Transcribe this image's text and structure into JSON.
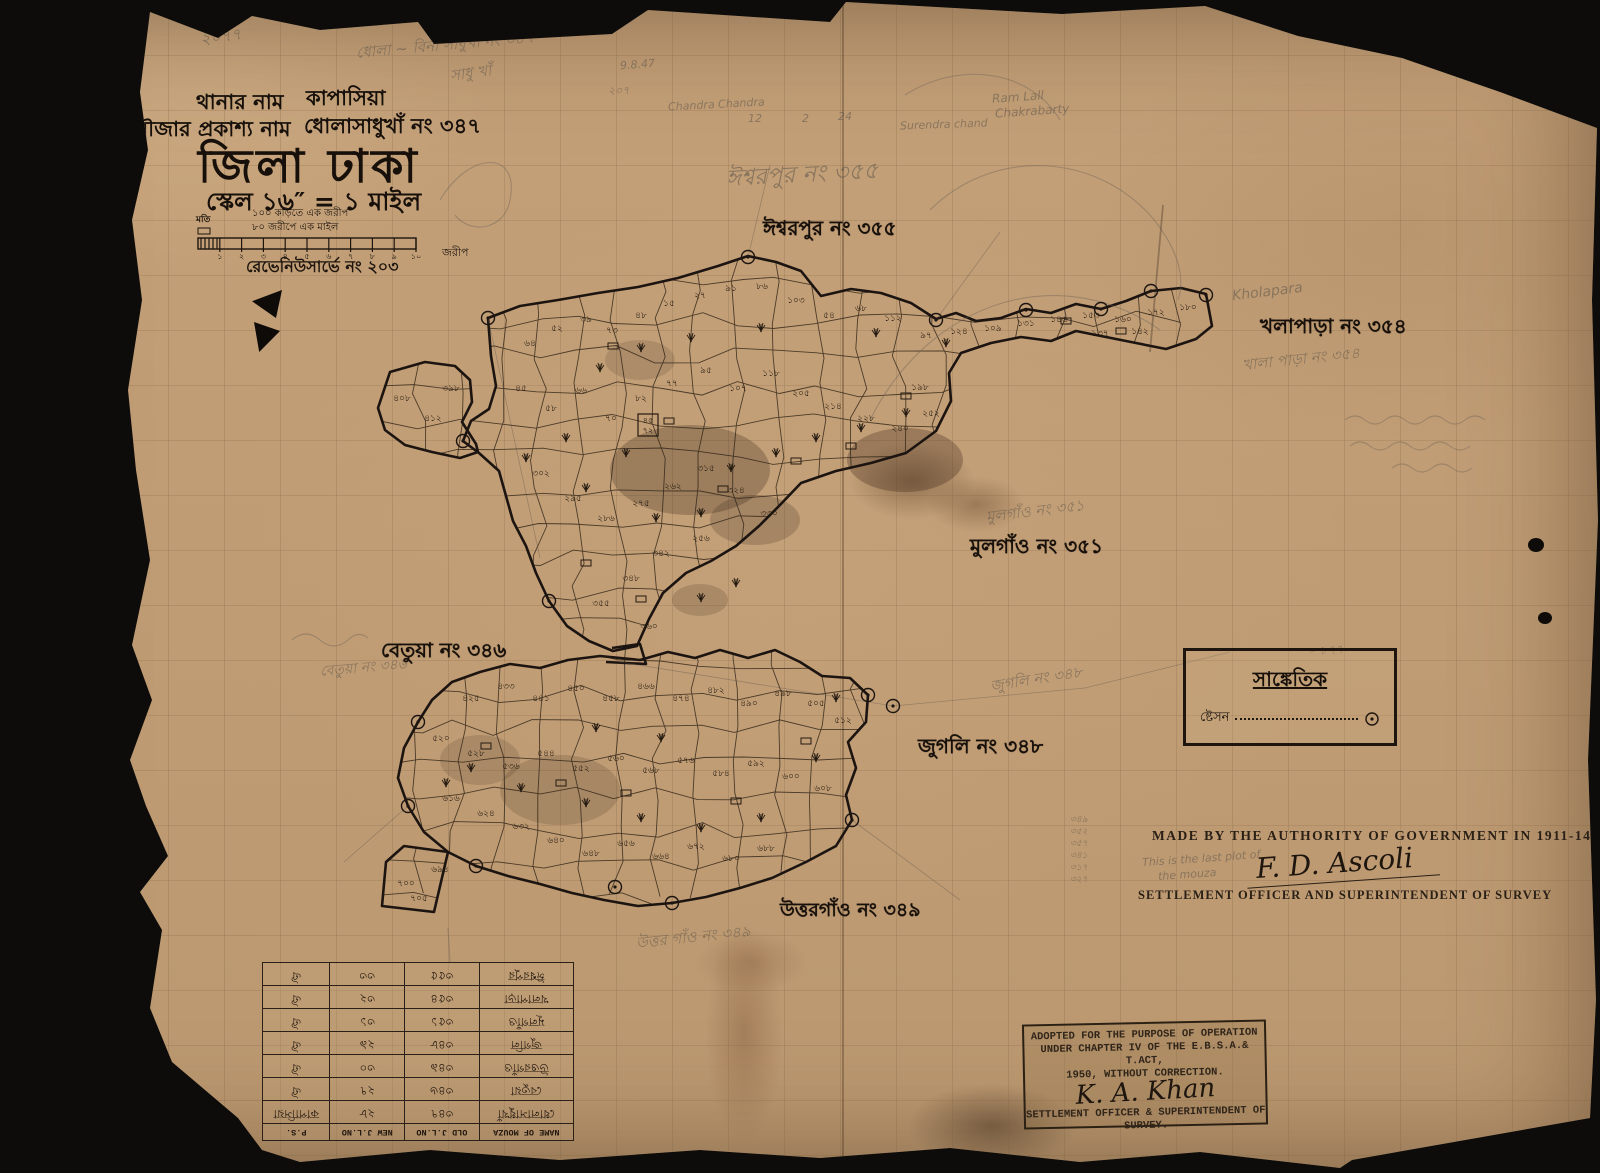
{
  "colors": {
    "ink": "#1d150e",
    "pencil": "#5d564b",
    "paper": "#c4a078",
    "boundary": "#1c1410"
  },
  "header": {
    "thana_label": "থানার নাম",
    "thana_value": "কাপাসিয়া",
    "mouza_label": "মৌজার প্রকাশ্য নাম",
    "mouza_value": "ধোলাসাধুখাঁ নং ৩৪৭",
    "district_title": "জিলা ঢাকা",
    "scale_line": "স্কেল ১৬″ = ১ মাইল",
    "scale_note1": "১০০ কড়িতে এক জরীপ",
    "scale_note2": "৮০ জরীপে এক মাইল",
    "scale_left_label": "মতি",
    "scale_ticks": [
      "১",
      "২",
      "৩",
      "৪",
      "৫",
      "৬",
      "৭",
      "৮",
      "৯",
      "১০"
    ],
    "scale_unit_right": "জরীপ",
    "survey_no": "রেভেনিউসার্ভে নং ২০৩"
  },
  "legend": {
    "title": "সাঙ্কেতিক",
    "station_label": "ষ্টেসন",
    "station_symbol": "station-circled-dot"
  },
  "authority": {
    "line1": "MADE BY THE AUTHORITY OF GOVERNMENT IN 1911-14",
    "signature": "F. D. Ascoli",
    "line2": "SETTLEMENT OFFICER AND SUPERINTENDENT OF SURVEY"
  },
  "stamp": {
    "line1": "ADOPTED FOR THE PURPOSE OF OPERATION",
    "line2": "UNDER CHAPTER IV OF THE E.B.S.A.& T.ACT,",
    "line3": "1950, WITHOUT CORRECTION.",
    "signature": "K. A. Khan",
    "line4": "SETTLEMENT OFFICER & SUPERINTENDENT OF",
    "line5": "SURVEY."
  },
  "table": {
    "headers": [
      "NAME OF MOUZA",
      "OLD J.L.NO",
      "NEW J.L.NO",
      "P.S."
    ],
    "rows": [
      [
        "ধোলাসাধুখাঁ",
        "৩৪৭",
        "২৮",
        "কাপাসিয়া"
      ],
      [
        "বেতুয়া",
        "৩৪৬",
        "২৭",
        "ঐ"
      ],
      [
        "উত্তরগাঁও",
        "৩৪৯",
        "৩০",
        "ঐ"
      ],
      [
        "জুগলি",
        "৩৪৮",
        "২৯",
        "ঐ"
      ],
      [
        "মূলগাঁও",
        "৩৫১",
        "৩১",
        "ঐ"
      ],
      [
        "খলাপাড়া",
        "৩৫৪",
        "৩২",
        "ঐ"
      ],
      [
        "ঈশ্বরপুর",
        "৩৫৫",
        "৩৩",
        "ঐ"
      ]
    ]
  },
  "map": {
    "region_labels": [
      {
        "t": "ঈশ্বরপুর নং ৩৫৫",
        "x": 763,
        "y": 214,
        "s": 20
      },
      {
        "t": "খলাপাড়া নং ৩৫৪",
        "x": 1260,
        "y": 312,
        "s": 20
      },
      {
        "t": "মুলগাঁও নং ৩৫১",
        "x": 970,
        "y": 532,
        "s": 20
      },
      {
        "t": "বেতুয়া নং ৩৪৬",
        "x": 381,
        "y": 636,
        "s": 20
      },
      {
        "t": "জুগলি নং ৩৪৮",
        "x": 918,
        "y": 732,
        "s": 20
      },
      {
        "t": "উত্তরগাঁও নং ৩৪৯",
        "x": 780,
        "y": 896,
        "s": 19
      }
    ],
    "pencil_notes": [
      {
        "t": "২০৭৭",
        "x": 200,
        "y": 24,
        "s": 16,
        "r": -8
      },
      {
        "t": "ধোলা ~ বিনা সাধুখাঁ নং ৩৪৭",
        "x": 356,
        "y": 34,
        "s": 15,
        "r": -5
      },
      {
        "t": "সাধু খাঁ",
        "x": 450,
        "y": 62,
        "s": 15,
        "r": -8
      },
      {
        "t": "9.8.47",
        "x": 620,
        "y": 58,
        "s": 11,
        "r": -4
      },
      {
        "t": "২০৭",
        "x": 608,
        "y": 82,
        "s": 11,
        "r": 0
      },
      {
        "t": "Chandra Chandra",
        "x": 668,
        "y": 98,
        "s": 11,
        "r": -3
      },
      {
        "t": "12",
        "x": 748,
        "y": 112,
        "s": 11,
        "r": 0
      },
      {
        "t": "2",
        "x": 802,
        "y": 112,
        "s": 11,
        "r": 0
      },
      {
        "t": "24",
        "x": 838,
        "y": 110,
        "s": 11,
        "r": 0
      },
      {
        "t": "Surendra chand",
        "x": 900,
        "y": 118,
        "s": 11,
        "r": -2
      },
      {
        "t": "Ram Lall",
        "x": 992,
        "y": 90,
        "s": 12,
        "r": -4
      },
      {
        "t": "Chakrabarty",
        "x": 995,
        "y": 104,
        "s": 12,
        "r": -4
      },
      {
        "t": "Kholapara",
        "x": 1232,
        "y": 284,
        "s": 14,
        "r": -7
      },
      {
        "t": "খালা পাড়া নং ৩৫৪",
        "x": 1242,
        "y": 348,
        "s": 15,
        "r": -6
      },
      {
        "t": "ঈশ্বরপুর নং ৩৫৫",
        "x": 726,
        "y": 156,
        "s": 23,
        "r": -3
      },
      {
        "t": "মুলগাঁও নং ৩৫১",
        "x": 986,
        "y": 500,
        "s": 15,
        "r": -7
      },
      {
        "t": "জুগলি নং ৩৪৮",
        "x": 990,
        "y": 668,
        "s": 15,
        "r": -9
      },
      {
        "t": "বেতুয়া নং ৩৪৬",
        "x": 320,
        "y": 656,
        "s": 14,
        "r": -5
      },
      {
        "t": "উত্তর গাঁও নং ৩৪৯",
        "x": 636,
        "y": 926,
        "s": 15,
        "r": -6
      },
      {
        "t": "This is the last plot of",
        "x": 1142,
        "y": 852,
        "s": 11,
        "r": -4
      },
      {
        "t": "the mouza",
        "x": 1158,
        "y": 868,
        "s": 11,
        "r": -4
      },
      {
        "t": "৮৭৭",
        "x": 1320,
        "y": 642,
        "s": 12,
        "r": -3
      },
      {
        "t": "৩৪৯",
        "x": 1070,
        "y": 812,
        "s": 9,
        "r": 0
      },
      {
        "t": "৩৫২",
        "x": 1070,
        "y": 824,
        "s": 9,
        "r": 0
      },
      {
        "t": "৩৫৭",
        "x": 1070,
        "y": 836,
        "s": 9,
        "r": 0
      },
      {
        "t": "৩৪১",
        "x": 1070,
        "y": 848,
        "s": 9,
        "r": 0
      },
      {
        "t": "৩১৭",
        "x": 1070,
        "y": 860,
        "s": 9,
        "r": 0
      },
      {
        "t": "৩২৭",
        "x": 1070,
        "y": 872,
        "s": 9,
        "r": 0
      }
    ],
    "boxed_label": {
      "top": "৪৫",
      "bottom": "৭২",
      "x": 648,
      "y": 424
    },
    "plot_labels": [
      {
        "t": "৬৪",
        "x": 530,
        "y": 346
      },
      {
        "t": "৫২",
        "x": 557,
        "y": 331
      },
      {
        "t": "৩৯",
        "x": 586,
        "y": 322
      },
      {
        "t": "৭৩",
        "x": 612,
        "y": 333
      },
      {
        "t": "৪৮",
        "x": 641,
        "y": 318
      },
      {
        "t": "১৫",
        "x": 669,
        "y": 306
      },
      {
        "t": "২৭",
        "x": 700,
        "y": 298
      },
      {
        "t": "৯১",
        "x": 731,
        "y": 291
      },
      {
        "t": "৮৬",
        "x": 762,
        "y": 289
      },
      {
        "t": "১০৩",
        "x": 796,
        "y": 303
      },
      {
        "t": "৫৪",
        "x": 829,
        "y": 318
      },
      {
        "t": "৬৮",
        "x": 861,
        "y": 311
      },
      {
        "t": "১১২",
        "x": 893,
        "y": 321
      },
      {
        "t": "৯৭",
        "x": 926,
        "y": 338
      },
      {
        "t": "১২৪",
        "x": 959,
        "y": 334
      },
      {
        "t": "১০৯",
        "x": 993,
        "y": 331
      },
      {
        "t": "১৩১",
        "x": 1026,
        "y": 326
      },
      {
        "t": "১৪৬",
        "x": 1059,
        "y": 322
      },
      {
        "t": "১৫৩",
        "x": 1091,
        "y": 318
      },
      {
        "t": "১৬০",
        "x": 1123,
        "y": 322
      },
      {
        "t": "১৭২",
        "x": 1156,
        "y": 315
      },
      {
        "t": "১৮০",
        "x": 1188,
        "y": 310
      },
      {
        "t": "১৩৭",
        "x": 1100,
        "y": 336
      },
      {
        "t": "১৪২",
        "x": 1140,
        "y": 334
      },
      {
        "t": "৪৫",
        "x": 521,
        "y": 391
      },
      {
        "t": "৫৮",
        "x": 551,
        "y": 411
      },
      {
        "t": "৬৬",
        "x": 581,
        "y": 393
      },
      {
        "t": "৭০",
        "x": 611,
        "y": 421
      },
      {
        "t": "৮২",
        "x": 641,
        "y": 401
      },
      {
        "t": "৭৭",
        "x": 672,
        "y": 386
      },
      {
        "t": "৯৫",
        "x": 706,
        "y": 373
      },
      {
        "t": "১০৭",
        "x": 738,
        "y": 391
      },
      {
        "t": "১১৮",
        "x": 771,
        "y": 376
      },
      {
        "t": "২০৫",
        "x": 801,
        "y": 396
      },
      {
        "t": "২১৪",
        "x": 833,
        "y": 409
      },
      {
        "t": "২২৮",
        "x": 866,
        "y": 421
      },
      {
        "t": "২৪০",
        "x": 900,
        "y": 431
      },
      {
        "t": "২৫২",
        "x": 931,
        "y": 416
      },
      {
        "t": "১৯৮",
        "x": 920,
        "y": 390
      },
      {
        "t": "৩০২",
        "x": 541,
        "y": 476
      },
      {
        "t": "২৯৫",
        "x": 573,
        "y": 501
      },
      {
        "t": "২৮৬",
        "x": 606,
        "y": 521
      },
      {
        "t": "২৭৫",
        "x": 641,
        "y": 506
      },
      {
        "t": "২৬২",
        "x": 673,
        "y": 489
      },
      {
        "t": "৩১৫",
        "x": 706,
        "y": 471
      },
      {
        "t": "৩২৪",
        "x": 736,
        "y": 493
      },
      {
        "t": "৩৩০",
        "x": 769,
        "y": 516
      },
      {
        "t": "২৫৬",
        "x": 701,
        "y": 541
      },
      {
        "t": "৩৪২",
        "x": 661,
        "y": 556
      },
      {
        "t": "৩৪৮",
        "x": 631,
        "y": 581
      },
      {
        "t": "৩৫৫",
        "x": 601,
        "y": 606
      },
      {
        "t": "৩৬০",
        "x": 649,
        "y": 629
      },
      {
        "t": "৪০৮",
        "x": 402,
        "y": 401
      },
      {
        "t": "৪১২",
        "x": 433,
        "y": 421
      },
      {
        "t": "৩৯৮",
        "x": 451,
        "y": 391
      },
      {
        "t": "৪২৫",
        "x": 471,
        "y": 701
      },
      {
        "t": "৪৩৩",
        "x": 506,
        "y": 689
      },
      {
        "t": "৪৪১",
        "x": 541,
        "y": 701
      },
      {
        "t": "৪৫০",
        "x": 576,
        "y": 691
      },
      {
        "t": "৪৫৮",
        "x": 611,
        "y": 701
      },
      {
        "t": "৪৬৬",
        "x": 646,
        "y": 689
      },
      {
        "t": "৪৭৪",
        "x": 681,
        "y": 701
      },
      {
        "t": "৪৮২",
        "x": 716,
        "y": 693
      },
      {
        "t": "৪৯০",
        "x": 749,
        "y": 706
      },
      {
        "t": "৪৯৮",
        "x": 783,
        "y": 696
      },
      {
        "t": "৫০৫",
        "x": 816,
        "y": 706
      },
      {
        "t": "৫১২",
        "x": 843,
        "y": 723
      },
      {
        "t": "৫২০",
        "x": 441,
        "y": 741
      },
      {
        "t": "৫২৮",
        "x": 476,
        "y": 756
      },
      {
        "t": "৫৩৬",
        "x": 511,
        "y": 769
      },
      {
        "t": "৫৪৪",
        "x": 546,
        "y": 756
      },
      {
        "t": "৫৫২",
        "x": 581,
        "y": 771
      },
      {
        "t": "৫৬০",
        "x": 616,
        "y": 761
      },
      {
        "t": "৫৬৮",
        "x": 651,
        "y": 773
      },
      {
        "t": "৫৭৬",
        "x": 686,
        "y": 763
      },
      {
        "t": "৫৮৪",
        "x": 721,
        "y": 776
      },
      {
        "t": "৫৯২",
        "x": 756,
        "y": 766
      },
      {
        "t": "৬০০",
        "x": 791,
        "y": 779
      },
      {
        "t": "৬০৮",
        "x": 823,
        "y": 791
      },
      {
        "t": "৬১৬",
        "x": 451,
        "y": 801
      },
      {
        "t": "৬২৪",
        "x": 486,
        "y": 816
      },
      {
        "t": "৬৩২",
        "x": 521,
        "y": 829
      },
      {
        "t": "৬৪০",
        "x": 556,
        "y": 843
      },
      {
        "t": "৬৪৮",
        "x": 591,
        "y": 856
      },
      {
        "t": "৬৫৬",
        "x": 626,
        "y": 846
      },
      {
        "t": "৬৬৪",
        "x": 661,
        "y": 859
      },
      {
        "t": "৬৭২",
        "x": 696,
        "y": 849
      },
      {
        "t": "৬৮০",
        "x": 731,
        "y": 861
      },
      {
        "t": "৬৮৮",
        "x": 766,
        "y": 851
      },
      {
        "t": "৭০০",
        "x": 406,
        "y": 886
      },
      {
        "t": "৭০৫",
        "x": 419,
        "y": 901
      },
      {
        "t": "৬৯৪",
        "x": 440,
        "y": 872
      }
    ],
    "symbols": {
      "trees": [
        [
          600,
          371
        ],
        [
          626,
          456
        ],
        [
          586,
          491
        ],
        [
          656,
          521
        ],
        [
          701,
          516
        ],
        [
          731,
          471
        ],
        [
          776,
          456
        ],
        [
          816,
          441
        ],
        [
          861,
          431
        ],
        [
          906,
          416
        ],
        [
          761,
          331
        ],
        [
          691,
          341
        ],
        [
          641,
          351
        ],
        [
          566,
          441
        ],
        [
          526,
          461
        ],
        [
          736,
          586
        ],
        [
          701,
          601
        ],
        [
          471,
          771
        ],
        [
          446,
          786
        ],
        [
          521,
          791
        ],
        [
          586,
          806
        ],
        [
          641,
          821
        ],
        [
          701,
          831
        ],
        [
          761,
          821
        ],
        [
          816,
          761
        ],
        [
          836,
          701
        ],
        [
          596,
          731
        ],
        [
          661,
          741
        ],
        [
          876,
          336
        ],
        [
          946,
          346
        ]
      ],
      "huts": [
        [
          613,
          346
        ],
        [
          669,
          421
        ],
        [
          723,
          489
        ],
        [
          796,
          461
        ],
        [
          851,
          446
        ],
        [
          906,
          396
        ],
        [
          586,
          563
        ],
        [
          641,
          599
        ],
        [
          486,
          746
        ],
        [
          561,
          783
        ],
        [
          626,
          793
        ],
        [
          736,
          801
        ],
        [
          806,
          741
        ],
        [
          1066,
          321
        ],
        [
          1121,
          331
        ]
      ],
      "stations": [
        [
          488,
          318
        ],
        [
          748,
          257
        ],
        [
          936,
          320
        ],
        [
          1026,
          310
        ],
        [
          1101,
          309
        ],
        [
          1151,
          291
        ],
        [
          1206,
          295
        ],
        [
          463,
          441
        ],
        [
          549,
          601
        ],
        [
          476,
          866
        ],
        [
          672,
          903
        ],
        [
          852,
          820
        ],
        [
          868,
          695
        ],
        [
          408,
          806
        ],
        [
          418,
          722
        ],
        [
          893,
          706
        ],
        [
          615,
          887
        ]
      ]
    }
  }
}
